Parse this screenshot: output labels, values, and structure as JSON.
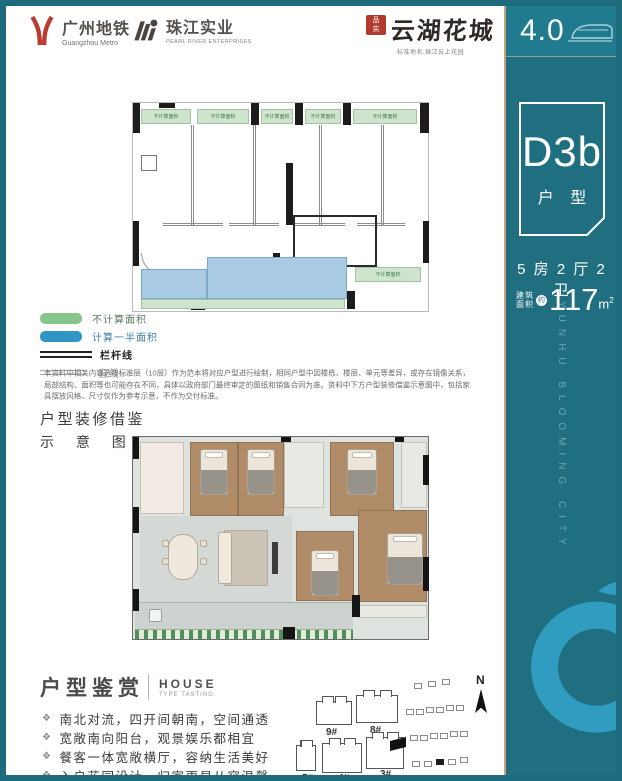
{
  "colors": {
    "teal": "#206f80",
    "teal_light": "#2f9cc0",
    "gold": "#c8a478",
    "legend_green": "#86c58b",
    "legend_blue": "#2f96c6"
  },
  "header": {
    "metro_cn": "广州地铁",
    "metro_en": "Guangzhou Metro",
    "pearl_cn": "珠江实业",
    "pearl_en": "PEARL RIVER ENTERPRISES",
    "seal_line1": "品",
    "seal_line2": "实",
    "brand": "云湖花城",
    "brand_sub": "标准地名:珠江云上花园",
    "badge": "4.0"
  },
  "sidebar": {
    "unit": "D3b",
    "unit_label": "户 型",
    "spec": "5 房 2 厅 2 卫",
    "area_label_1": "建筑",
    "area_label_2": "面积",
    "area_approx": "约",
    "area_value": "117",
    "area_unit_base": "m",
    "area_unit_sup": "2",
    "watermark": "YUNHU BLOOMING CITY"
  },
  "tech_plan": {
    "green_label": "不计算面积"
  },
  "legend": {
    "green": "不计算面积",
    "blue": "计算一半面积",
    "rail": "栏杆线",
    "window": "窗线"
  },
  "disclaimer": "本资料中相关内容选取标准层（10层）作为范本将对应户型进行绘制，相同户型中因楼栋、楼层、单元等差异，或存在镜像关系，局部结构、面积等也可能存在不同，具体以政府部门最终审定的图纸和销售合同为准。资料中下方户型装修借鉴示意图中，包括家具摆放风格、尺寸仅作为参考示意，不作为交付标准。",
  "render_note": {
    "line1": "户型装修借鉴",
    "line2": "示 意 图"
  },
  "appreciation": {
    "title": "户型鉴赏",
    "en": "HOUSE",
    "en_sub": "TYPE TASTING",
    "bullet_char": "❖",
    "bullets": [
      "南北对流，四开间朝南，空间通透",
      "宽敞南向阳台，观景娱乐都相宜",
      "餐客一体宽敞横厅，容纳生活美好",
      "入户花园设计，归家更显从容温馨"
    ]
  },
  "siteplan": {
    "b9": "9#",
    "b8": "8#",
    "b5": "5#",
    "b4": "4#",
    "b3": "3#",
    "north": "N"
  }
}
